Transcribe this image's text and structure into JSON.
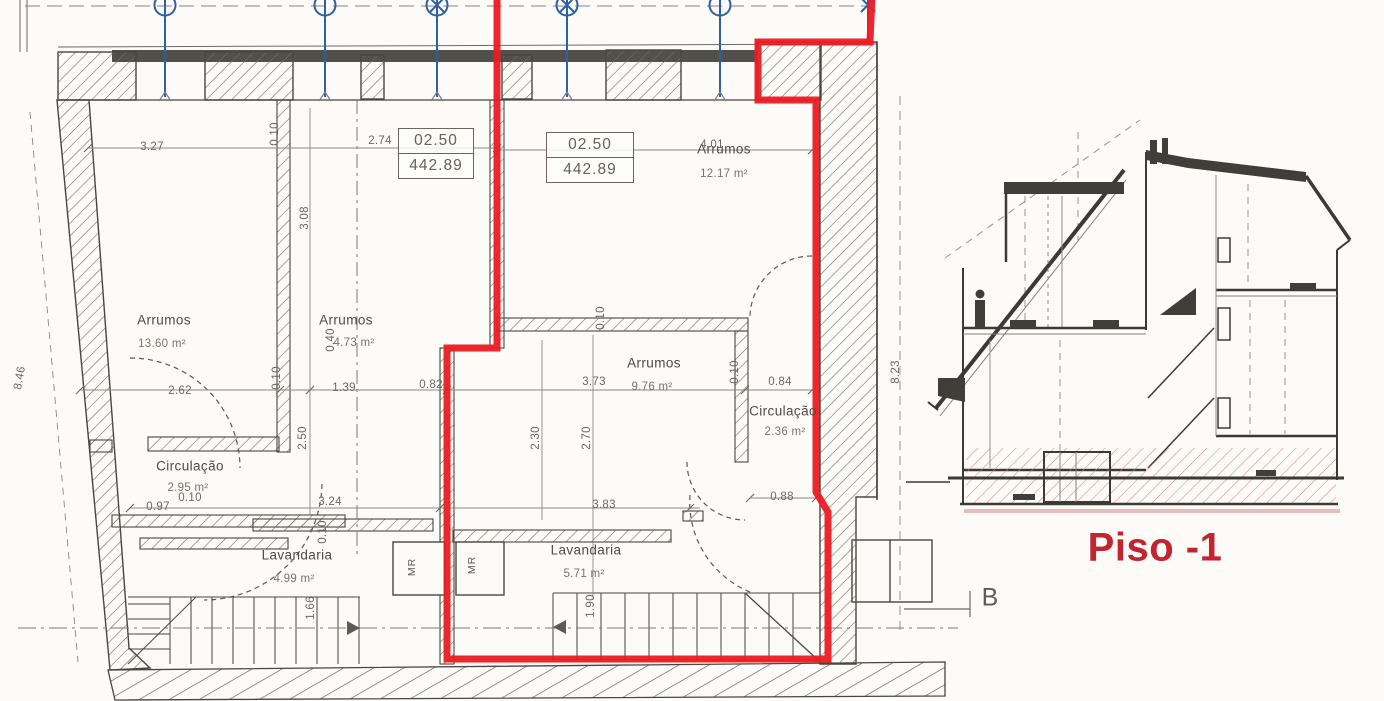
{
  "plan": {
    "rooms": [
      {
        "name": "Arrumos",
        "area": "13.60 m²"
      },
      {
        "name": "Arrumos",
        "area": "4.73 m²"
      },
      {
        "name": "Arrumos",
        "area": "12.17 m²"
      },
      {
        "name": "Arrumos",
        "area": "9.76 m²"
      },
      {
        "name": "Circulação",
        "area": "2.95 m²"
      },
      {
        "name": "Circulação",
        "area": "2.36 m²"
      },
      {
        "name": "Lavandaria",
        "area": "4.99 m²"
      },
      {
        "name": "Lavandaria",
        "area": "5.71 m²"
      }
    ],
    "levels": [
      {
        "elevation": "02.50",
        "datum": "442.89"
      },
      {
        "elevation": "02.50",
        "datum": "442.89"
      }
    ],
    "dimensions": [
      "3.27",
      "2.74",
      "4.01",
      "2.62",
      "1.39",
      "0.82",
      "3.73",
      "0.84",
      "0.97",
      "3.24",
      "3.83",
      "0.88",
      "8.46",
      "3.08",
      "2.50",
      "2.30",
      "2.70",
      "8.23",
      "0.10",
      "0.10",
      "0.40",
      "0.10",
      "0.10",
      "0.10",
      "1.66",
      "1.90",
      "0.10"
    ],
    "closet_labels": [
      "MR",
      "MR"
    ]
  },
  "section": {
    "caption": "Piso -1",
    "cut_label": "B"
  },
  "colors": {
    "highlight_outline": "#ec1b23",
    "caption_red": "#c22430",
    "grid_blue": "#2f5fa6",
    "ink": "#4a463f"
  }
}
